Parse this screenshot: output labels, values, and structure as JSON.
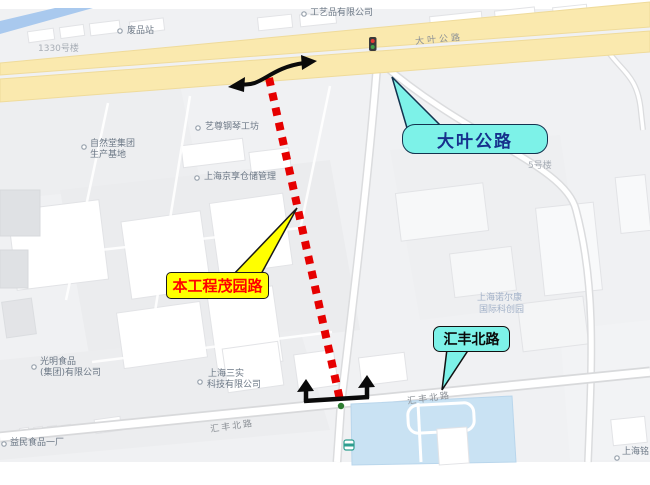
{
  "figure": {
    "type": "annotated-road-map"
  },
  "callouts": {
    "project": {
      "label": "本工程茂园路"
    },
    "daye": {
      "label": "大叶公路"
    },
    "huifeng": {
      "label": "汇丰北路"
    }
  },
  "road_labels": {
    "daye": "大叶公路",
    "huifeng_west": "汇丰北路",
    "huifeng_east": "汇丰北路"
  },
  "pois": {
    "gongyipin": "工艺品有限公司",
    "feipinzhan": "废品站",
    "bldg1330": "1330号楼",
    "ziran1": "自然堂集团",
    "ziran2": "生产基地",
    "yizun": "艺尊钢琴工坊",
    "jingxiang": "上海京享仓储管理",
    "bldg5": "5号楼",
    "nek1": "上海诺尔康",
    "nek2": "国际科创园",
    "guangming1": "光明食品",
    "guangming2": "(集团)有限公司",
    "sanshi1": "上海三实",
    "sanshi2": "科技有限公司",
    "yimin": "益民食品一厂",
    "shanghaiming": "上海铭"
  },
  "colors": {
    "route_red": "#E60000",
    "callout_yellow": "#FFFF00",
    "callout_cyan": "#7DF2E8",
    "project_text_red": "#FF0000",
    "daye_text_navy": "#16308C",
    "road_yellow": "#FAE9AE",
    "river_blue": "#A9C9EE",
    "pond_blue": "#C9E2F3"
  }
}
